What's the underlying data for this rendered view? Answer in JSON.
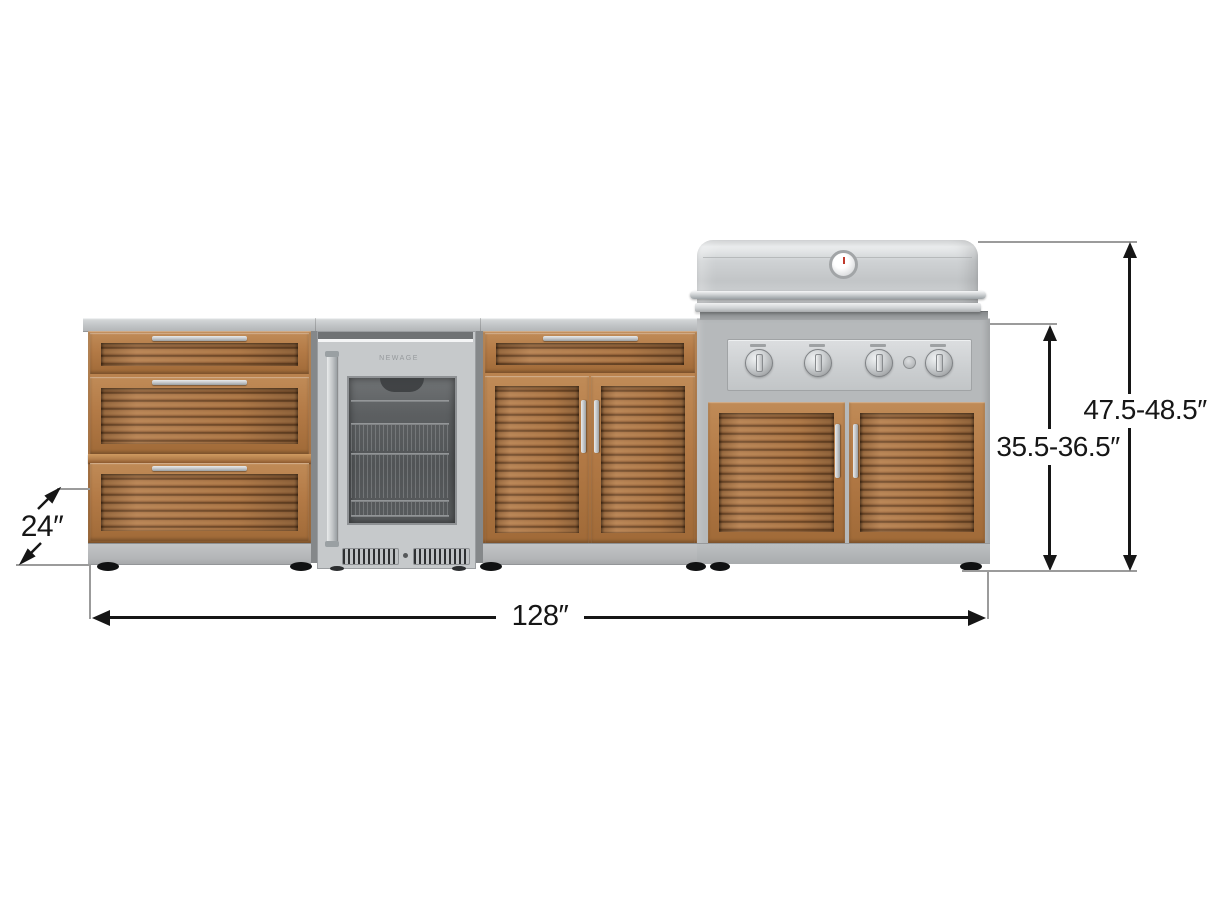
{
  "dimension_labels": {
    "depth": "24″",
    "width": "128″",
    "counter_height": "35.5-36.5″",
    "overall_height": "47.5-48.5″"
  },
  "fridge": {
    "logo": "NEWAGE"
  },
  "colors": {
    "background": "#ffffff",
    "wood_frame": "#b5804c",
    "wood_slats": "#8f5c33",
    "stainless": "#c6c9cb",
    "cabinet_gray": "#b6b9bb",
    "dimension_line": "#161616",
    "extension_line": "#9b9b9b"
  }
}
